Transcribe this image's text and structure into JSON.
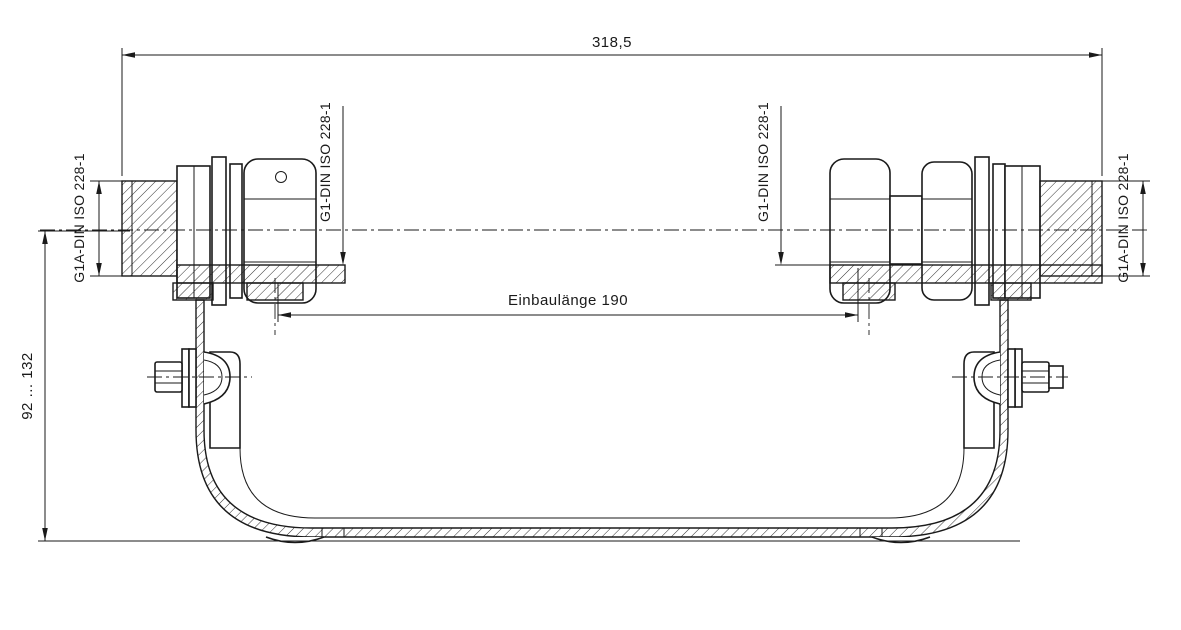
{
  "drawing": {
    "title_hint": "mounting bracket with two pipe unions, sectional technical drawing",
    "dim_overall_width": "318,5",
    "dim_installation": "Einbaulänge 190",
    "dim_height_range": "92 ... 132",
    "thread_left_outer": "G1A-DIN ISO 228-1",
    "thread_left_inner": "G1-DIN ISO 228-1",
    "thread_right_inner": "G1-DIN ISO 228-1",
    "thread_right_outer": "G1A-DIN ISO 228-1"
  },
  "colors": {
    "line": "#1a1a1a",
    "background": "#ffffff"
  }
}
